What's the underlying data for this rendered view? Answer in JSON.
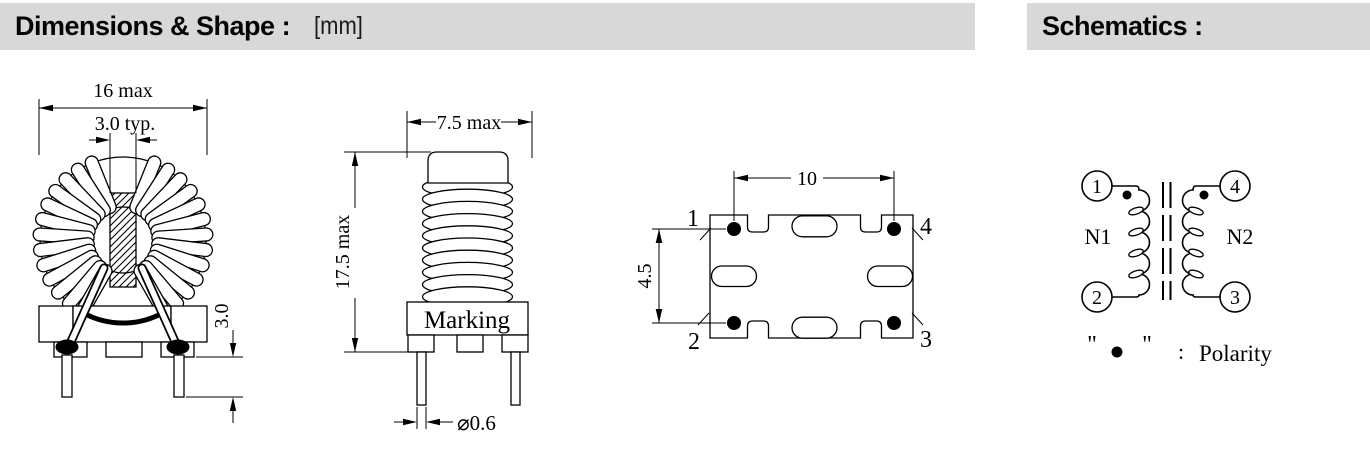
{
  "header": {
    "dimensions_title": "Dimensions & Shape :",
    "unit": "[mm]",
    "schematics_title": "Schematics :"
  },
  "front_view": {
    "dim_outer_diameter": "16 max",
    "dim_core_width": "3.0 typ.",
    "dim_pin_protrusion": "3.0"
  },
  "side_view": {
    "dim_body_width": "7.5 max",
    "dim_body_height": "17.5 max",
    "marking_label": "Marking",
    "dim_lead_diameter": "⌀0.6"
  },
  "bottom_view": {
    "dim_pin_span": "10",
    "dim_pin_pitch": "4.5",
    "pins": {
      "p1": "1",
      "p2": "2",
      "p3": "3",
      "p4": "4"
    }
  },
  "schematic": {
    "pins": {
      "p1": "1",
      "p2": "2",
      "p3": "3",
      "p4": "4"
    },
    "windings": {
      "left": "N1",
      "right": "N2"
    },
    "legend": {
      "quote_open": "\"",
      "quote_close": "\"",
      "colon": ":",
      "label": "Polarity"
    }
  },
  "colors": {
    "header_bg": "#d8d8d8",
    "line": "#000000",
    "fill": "#ffffff"
  }
}
